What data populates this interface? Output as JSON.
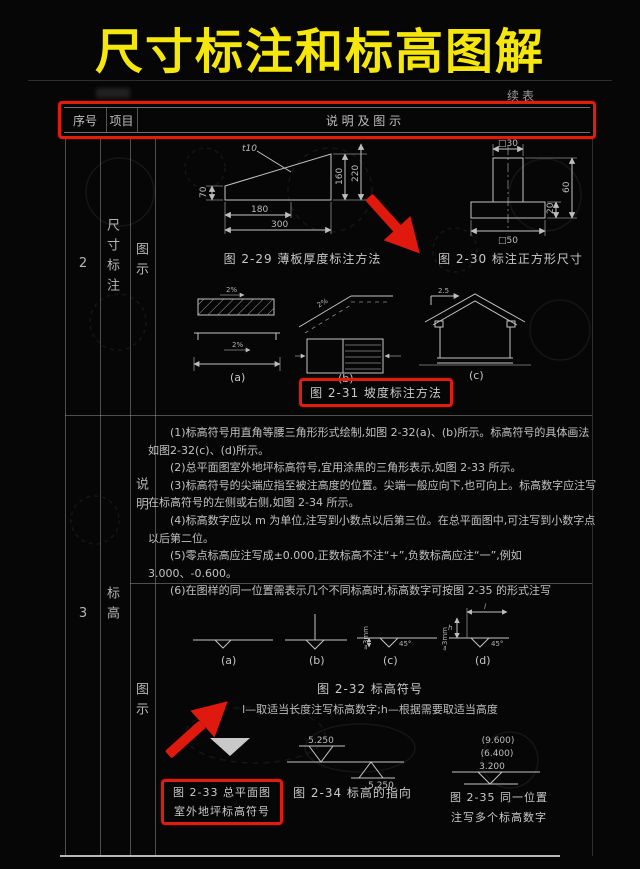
{
  "page": {
    "title": "尺寸标注和标高图解",
    "continued": "续表"
  },
  "header": {
    "seq": "序号",
    "item": "项目",
    "desc": "说 明 及 图 示"
  },
  "rows": {
    "r2": {
      "seq": "2",
      "item": "尺寸标注",
      "sub": "图示"
    },
    "r3": {
      "seq": "3",
      "item": "标高",
      "sub_note": "说明",
      "sub_fig": "图示"
    }
  },
  "notes": [
    "(1)标高符号用直角等腰三角形形式绘制,如图 2-32(a)、(b)所示。标高符号的具体画法如图2-32(c)、(d)所示。",
    "(2)总平面图室外地坪标高符号,宜用涂黑的三角形表示,如图 2-33 所示。",
    "(3)标高符号的尖端应指至被注高度的位置。尖端一般应向下,也可向上。标高数字应注写在标高符号的左侧或右侧,如图 2-34 所示。",
    "(4)标高数字应以 m 为单位,注写到小数点以后第三位。在总平面图中,可注写到小数字点以后第二位。",
    "(5)零点标高应注写成±0.000,正数标高不注“+”,负数标高应注“一”,例如 3.000、-0.600。",
    "(6)在图样的同一位置需表示几个不同标高时,标高数字可按图 2-35 的形式注写"
  ],
  "fig229": {
    "caption": "图 2-29  薄板厚度标注方法",
    "t": "t10",
    "dim_left": "70",
    "dim_r1": "160",
    "dim_r2": "220",
    "dim_b1": "180",
    "dim_b2": "300"
  },
  "fig230": {
    "caption": "图 2-30  标注正方形尺寸",
    "dim_top": "□30",
    "dim_r1": "20",
    "dim_r2": "60",
    "dim_b": "□50"
  },
  "fig231": {
    "caption": "图 2-31  坡度标注方法",
    "a": "(a)",
    "b": "(b)",
    "c": "(c)",
    "slope_a1": "2%",
    "slope_a2": "2%",
    "slope_b": "2%",
    "slope_c": "2.5"
  },
  "fig232": {
    "caption": "图 2-32  标高符号",
    "legend": "l—取适当长度注写标高数字;h—根据需要取适当高度",
    "a": "(a)",
    "b": "(b)",
    "c": "(c)",
    "d": "(d)",
    "angle_c": "45°",
    "angle_d": "45°",
    "mm_c": "≈3mm",
    "mm_d": "≈3mm",
    "len": "l",
    "ht": "h"
  },
  "fig233": {
    "caption1": "图 2-33  总平面图",
    "caption2": "室外地坪标高符号"
  },
  "fig234": {
    "caption": "图 2-34  标高的指向",
    "top_val": "5.250",
    "bottom_val": "5.250"
  },
  "fig235": {
    "caption1": "图 2-35  同一位置",
    "caption2": "注写多个标高数字",
    "v1": "(9.600)",
    "v2": "(6.400)",
    "v3": "3.200"
  }
}
